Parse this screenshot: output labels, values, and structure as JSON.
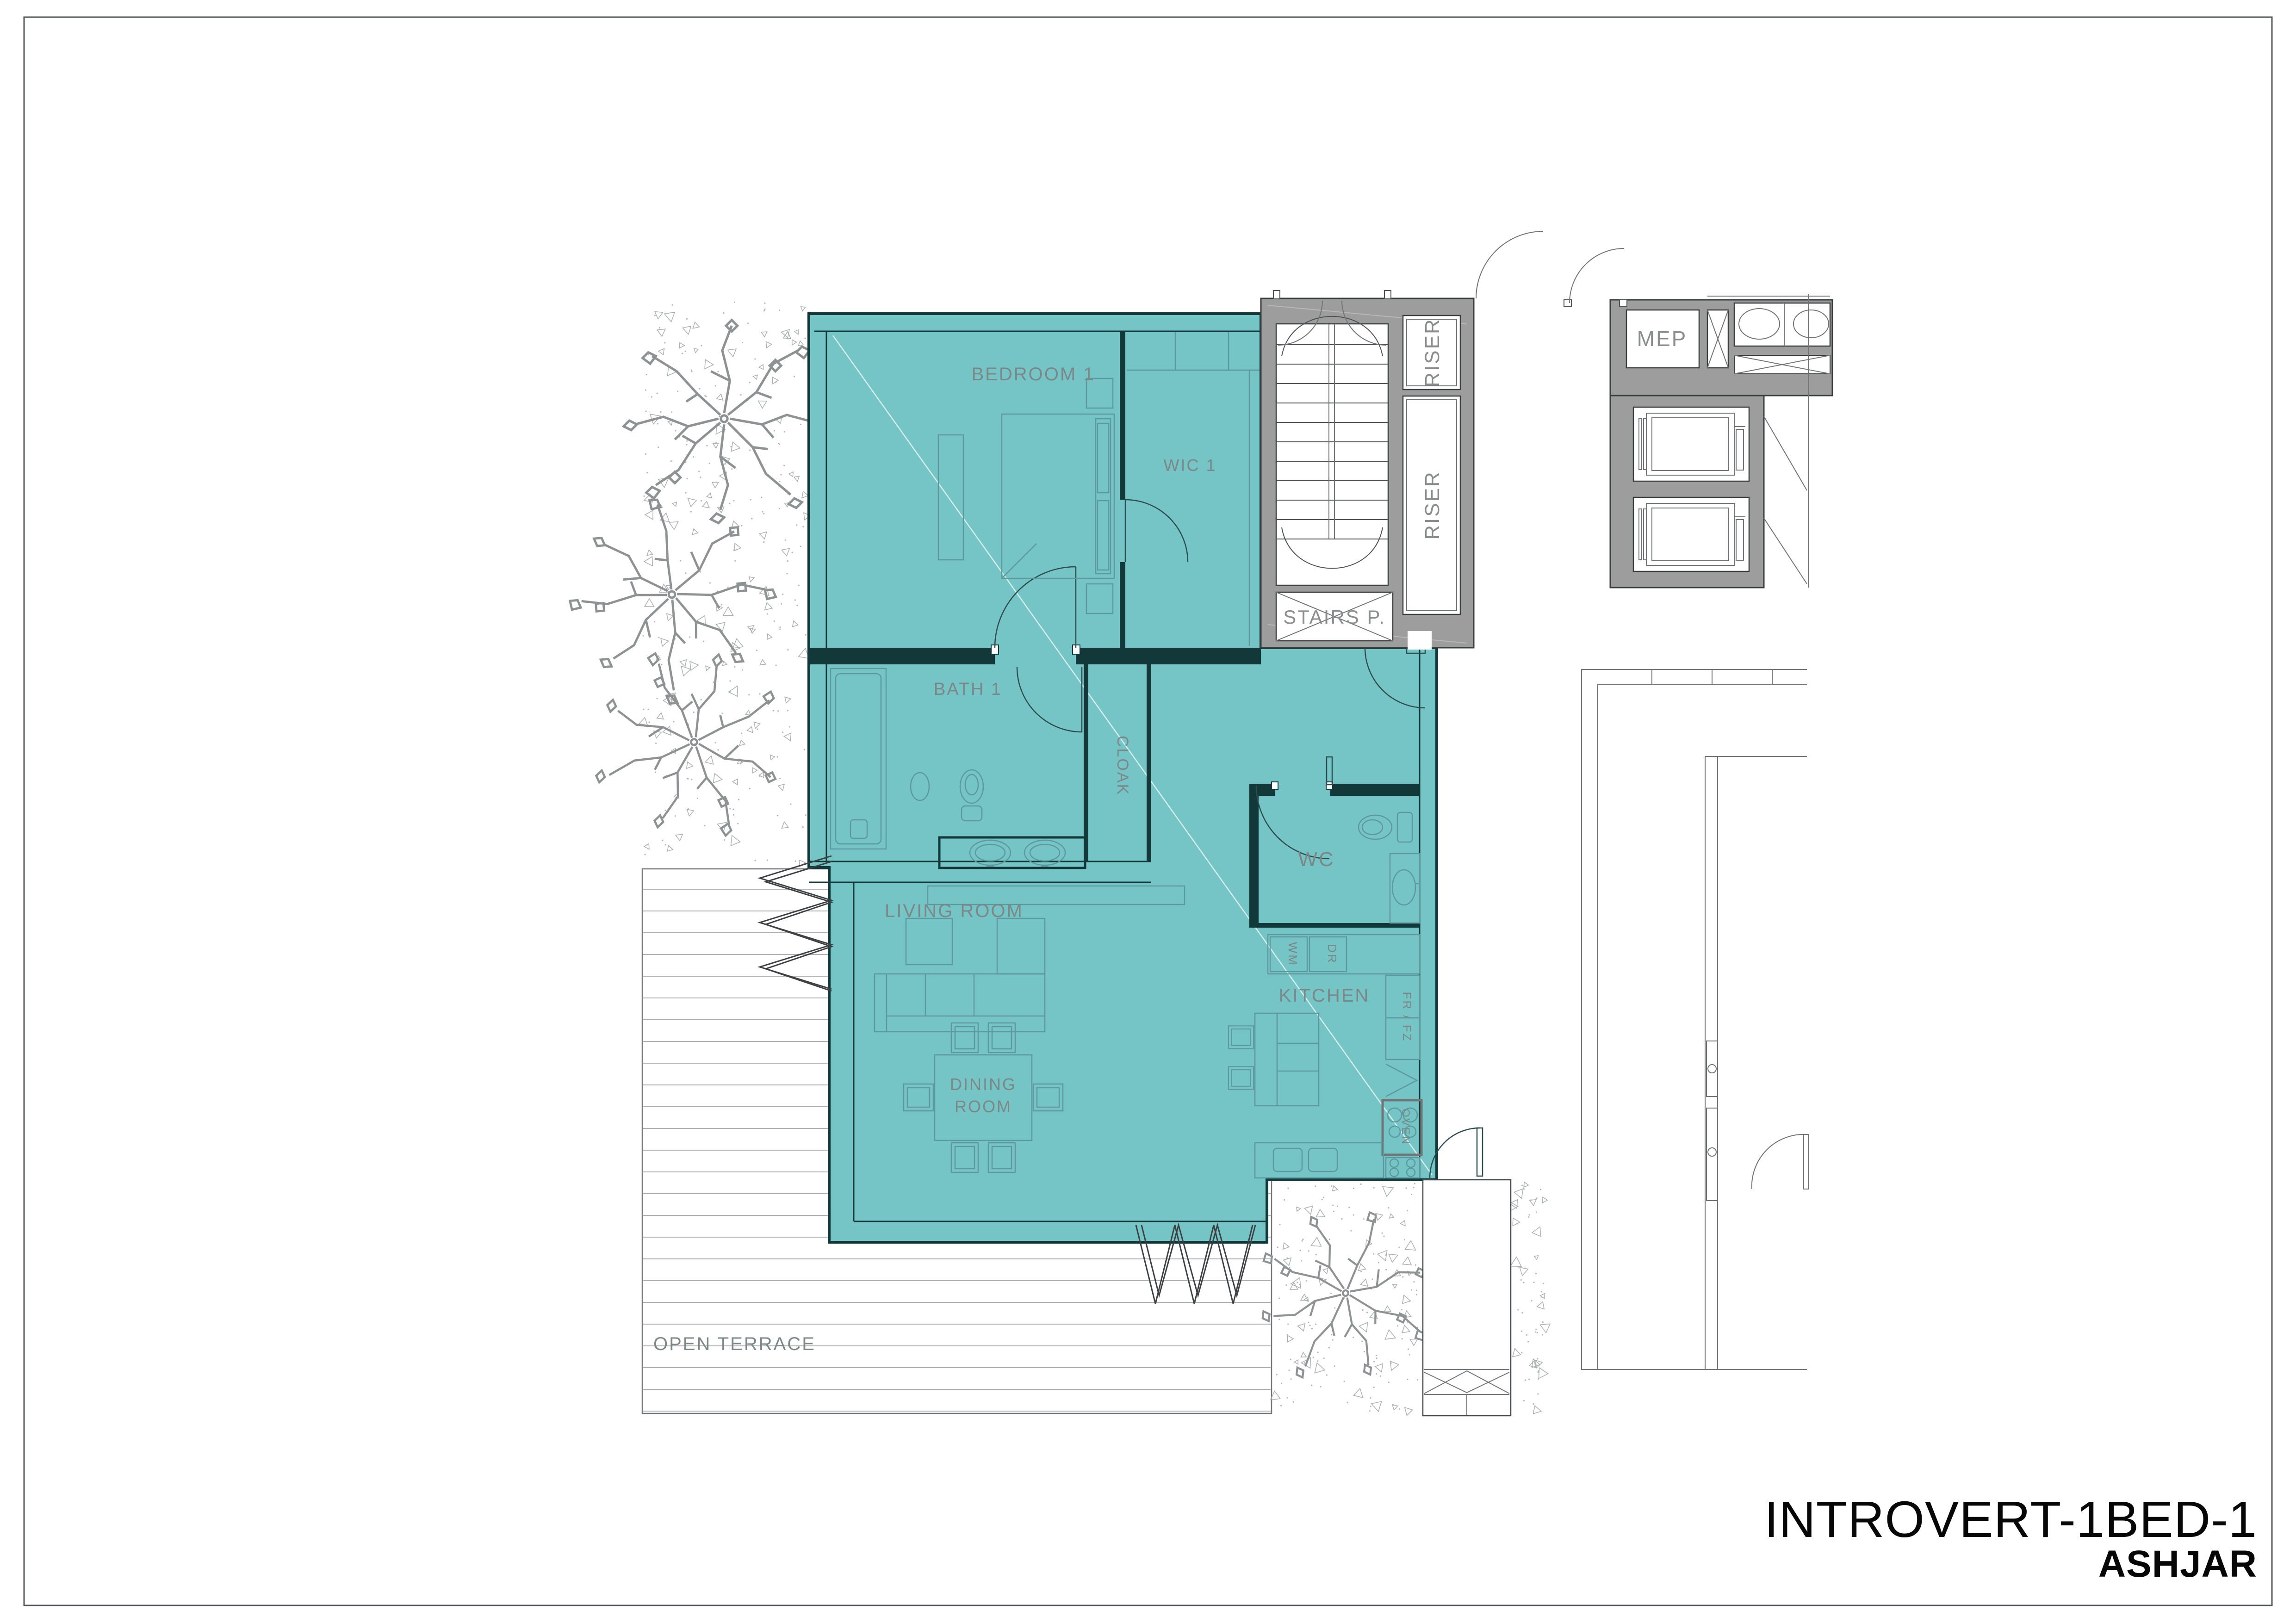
{
  "drawing": {
    "unit_title": "INTROVERT-1BED-1",
    "project_name": "ASHJAR",
    "rooms": {
      "bedroom": "BEDROOM 1",
      "wic": "WIC 1",
      "bath": "BATH 1",
      "cloak": "CLOAK",
      "living": "LIVING ROOM",
      "dining_line1": "DINING",
      "dining_line2": "ROOM",
      "kitchen": "KITCHEN",
      "wc": "WC"
    },
    "core": {
      "stairs": "STAIRS P.",
      "riser_top": "RISER",
      "riser_bottom": "RISER",
      "mep": "MEP"
    },
    "appliances": {
      "washing_machine": "WM",
      "dryer": "DR",
      "fridge_freezer": "FR / FZ",
      "oven": "OVEN"
    },
    "outdoor": {
      "terrace": "OPEN TERRACE"
    },
    "colors": {
      "unit_fill": "#75c5c7",
      "wall_dark": "#12383a",
      "core_gray": "#9d9d9d",
      "label_gray": "#7c8788",
      "furniture_teal": "#5d989c"
    }
  }
}
